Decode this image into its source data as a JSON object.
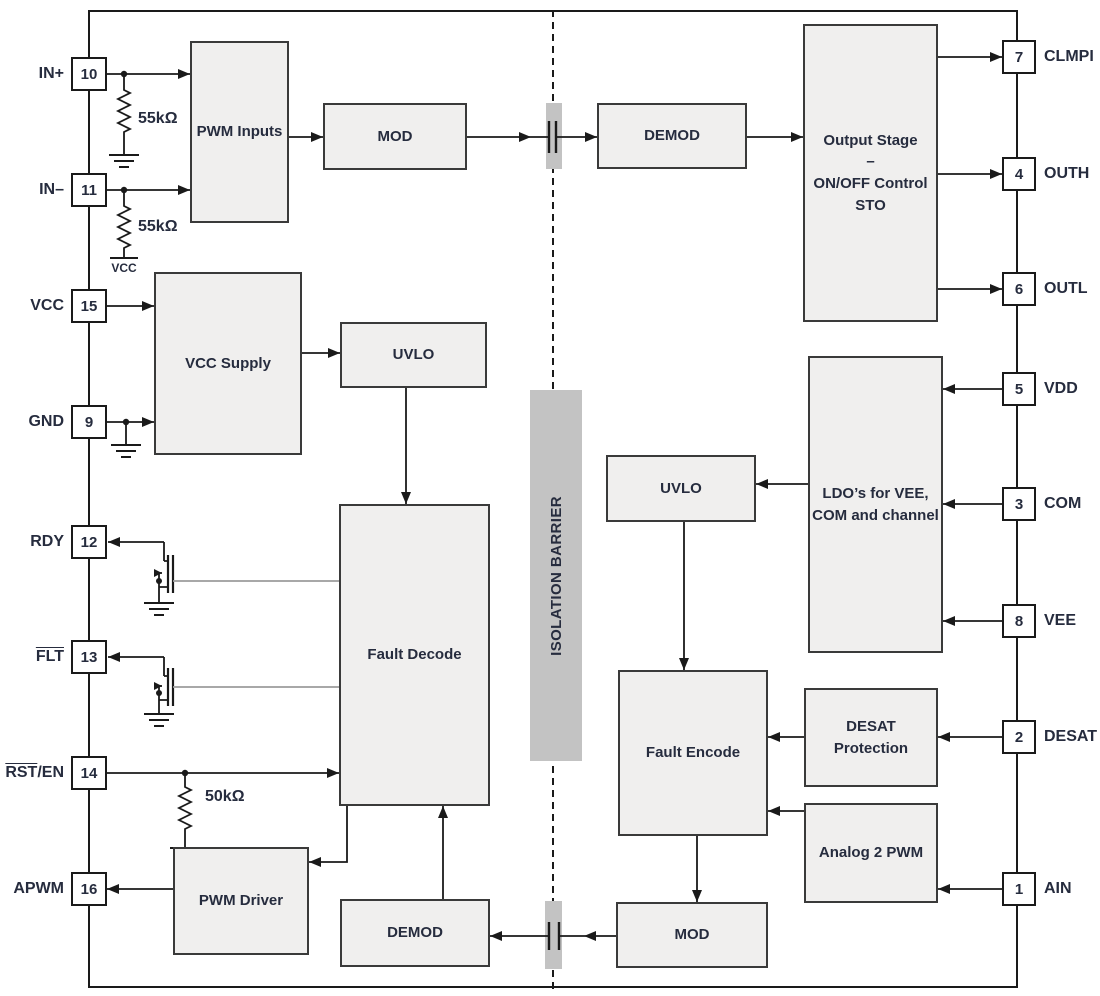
{
  "diagram": {
    "barrier": {
      "label": "ISOLATION BARRIER"
    },
    "left_pins": [
      {
        "num": "10",
        "label": "IN+"
      },
      {
        "num": "11",
        "label": "IN–"
      },
      {
        "num": "15",
        "label": "VCC"
      },
      {
        "num": "9",
        "label": "GND"
      },
      {
        "num": "12",
        "label": "RDY"
      },
      {
        "num": "13",
        "label": "FLT"
      },
      {
        "num": "14",
        "label_over": "RST",
        "label_rest": "/EN"
      },
      {
        "num": "16",
        "label": "APWM"
      }
    ],
    "right_pins": [
      {
        "num": "7",
        "label": "CLMPI"
      },
      {
        "num": "4",
        "label": "OUTH"
      },
      {
        "num": "6",
        "label": "OUTL"
      },
      {
        "num": "5",
        "label": "VDD"
      },
      {
        "num": "3",
        "label": "COM"
      },
      {
        "num": "8",
        "label": "VEE"
      },
      {
        "num": "2",
        "label": "DESAT"
      },
      {
        "num": "1",
        "label": "AIN"
      }
    ],
    "blocks": {
      "pwm_inputs": "PWM Inputs",
      "mod_top": "MOD",
      "demod_top": "DEMOD",
      "output_stage": [
        "Output Stage",
        "–",
        "ON/OFF Control",
        "STO"
      ],
      "vcc_supply": "VCC Supply",
      "uvlo_left": "UVLO",
      "fault_decode": "Fault Decode",
      "uvlo_right": "UVLO",
      "ldo": [
        "LDO’s for VEE,",
        "COM and channel"
      ],
      "fault_encode": "Fault Encode",
      "desat_protection": "DESAT Protection",
      "analog_2_pwm": "Analog 2 PWM",
      "pwm_driver": "PWM Driver",
      "demod_bottom": "DEMOD",
      "mod_bottom": "MOD"
    },
    "resistors": {
      "in_plus": "55kΩ",
      "in_minus": "55kΩ",
      "rst_en": "50kΩ"
    },
    "rails": {
      "vcc": "VCC"
    },
    "colors": {
      "block_fill": "#f0efee",
      "block_border": "#3a3a3a",
      "wire": "#1a1a1a",
      "gray_wire": "#9c9c9c",
      "barrier_fill": "#c3c3c3",
      "text": "#262c3e"
    }
  }
}
